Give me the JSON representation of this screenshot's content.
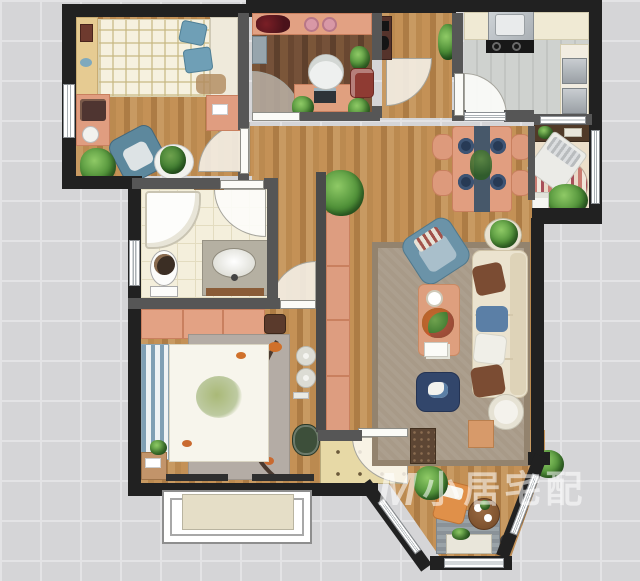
{
  "watermark": {
    "logo": "M",
    "text": "小居宅配"
  },
  "palette": {
    "background_grid": "#d5d5d7",
    "exterior_wall": "#212121",
    "interior_wall": "#565656",
    "wood_floor": "#c08c55",
    "dark_wood_floor": "#6e4c34",
    "kitchen_tile": "#cbcecb",
    "bathroom_tile": "#f4efdc",
    "entry_tile": "#e7d9a6",
    "living_rug": "#a89a88",
    "master_rug": "#b4aca5",
    "accent_salmon": "#e09d80",
    "accent_blue": "#6b93a8",
    "sofa_cream": "#ebe3cf",
    "navy_pouf": "#32466b",
    "plant_green": "#4e8f3a",
    "watermark_color": "rgba(255,255,255,0.55)"
  },
  "rooms": [
    {
      "id": "bedroom-secondary",
      "area": "top-left",
      "furniture": [
        "single-bed",
        "plaid-duvet",
        "blue-pillows",
        "headboard",
        "wall-shelf",
        "vanity-desk",
        "stool",
        "blue-armchair",
        "potted-plant",
        "round-rug",
        "dresser",
        "door"
      ]
    },
    {
      "id": "study",
      "area": "top-center",
      "furniture": [
        "display-shelf",
        "decor-plates",
        "desk",
        "laptop",
        "office-chair",
        "reading-chair",
        "storage-cabinet",
        "potted-plants",
        "door"
      ]
    },
    {
      "id": "kitchen",
      "area": "top-right",
      "furniture": [
        "counter",
        "sink",
        "cooktop",
        "tall-counter",
        "appliances",
        "door"
      ]
    },
    {
      "id": "bathroom",
      "area": "middle-left",
      "furniture": [
        "corner-shower",
        "toilet",
        "vanity-sink",
        "wall-shelf",
        "window",
        "door"
      ]
    },
    {
      "id": "dining-area",
      "area": "middle-right",
      "furniture": [
        "dining-table",
        "table-runner",
        "four-chairs",
        "place-settings",
        "centerpiece"
      ]
    },
    {
      "id": "leisure-nook",
      "area": "right",
      "furniture": [
        "wall-shelf",
        "daybed",
        "striped-round-rug",
        "large-plant",
        "books",
        "window"
      ]
    },
    {
      "id": "living-room",
      "area": "center",
      "furniture": [
        "area-rug",
        "sofa",
        "throw-pillows",
        "blue-armchair",
        "coffee-table",
        "ottoman",
        "side-table",
        "console-cabinet",
        "plants",
        "bench",
        "doormat"
      ]
    },
    {
      "id": "master-bedroom",
      "area": "bottom-left",
      "furniture": [
        "double-bed",
        "floral-duvet",
        "striped-headboard",
        "wardrobe",
        "branch-rug",
        "nightstand",
        "speakers",
        "beanbag",
        "bay-window"
      ]
    },
    {
      "id": "entry",
      "area": "bottom-center",
      "furniture": [
        "entry-door",
        "door-arc",
        "patterned-tile"
      ]
    },
    {
      "id": "balcony",
      "area": "bottom-right",
      "furniture": [
        "lounge-cushion",
        "round-tea-table",
        "storage-bench",
        "plants",
        "gray-rug",
        "windows"
      ]
    }
  ]
}
